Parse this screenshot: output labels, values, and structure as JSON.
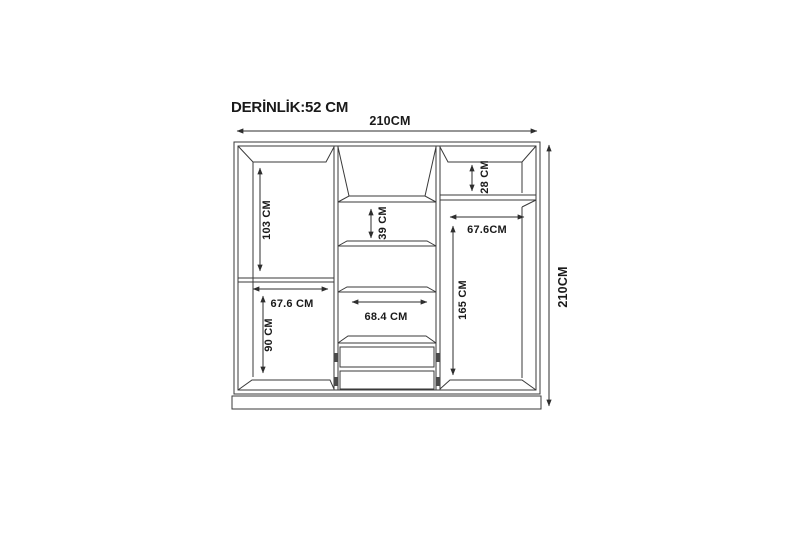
{
  "diagram": {
    "depth_label": "DERİNLİK:52 CM",
    "dimensions": {
      "overall_width": "210CM",
      "overall_height": "210CM",
      "left_upper_height": "103 CM",
      "left_lower_width": "67.6 CM",
      "left_lower_height": "90 CM",
      "middle_shelf_gap": "39 CM",
      "middle_lower_width": "68.4 CM",
      "right_top_shelf_height": "28 CM",
      "right_section_width": "67.6CM",
      "right_section_height": "165 CM"
    },
    "colors": {
      "background": "#ffffff",
      "line": "#3a3a3a",
      "text": "#1a1a1a"
    }
  }
}
